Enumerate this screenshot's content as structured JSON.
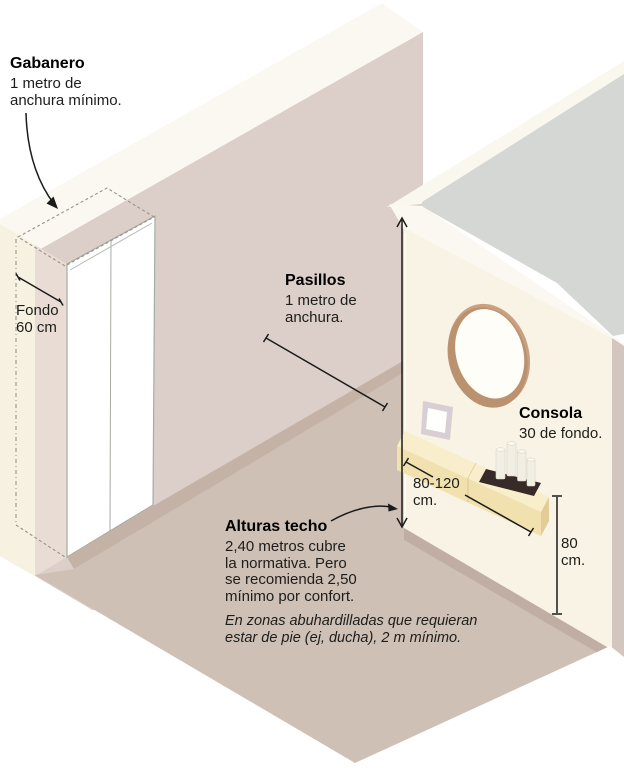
{
  "figure": {
    "type": "isometric-hallway-infographic",
    "language": "es"
  },
  "palette": {
    "background": "#ffffff",
    "left_wall": "#dccfc9",
    "wall_top_band": "#fbf8f1",
    "right_wall": "#f8f3e4",
    "hall_floor": "#cfc0b5",
    "room_floor_gray": "#d5d7d4",
    "baseboard": "#c2b0a6",
    "mirror_frame_wood": "#c9a180",
    "console_wood": "#f1e1ae",
    "tray_dark": "#382a28",
    "ink": "#1b1b1b"
  },
  "annotations": {
    "gabanero": {
      "title": "Gabanero",
      "lines": [
        "1 metro de",
        "anchura mínimo."
      ]
    },
    "fondo": {
      "lines": [
        "Fondo",
        "60 cm"
      ]
    },
    "pasillos": {
      "title": "Pasillos",
      "lines": [
        "1 metro de",
        "anchura."
      ]
    },
    "consola": {
      "title": "Consola",
      "lines": [
        "30 de fondo."
      ]
    },
    "consola_ancho": {
      "lines": [
        "80-120",
        "cm."
      ]
    },
    "consola_alto": {
      "lines": [
        "80",
        "cm."
      ]
    },
    "alturas": {
      "title": "Alturas techo",
      "lines": [
        "2,40 metros cubre",
        "la normativa. Pero",
        "se recomienda 2,50",
        "mínimo por confort."
      ],
      "note_lines": [
        "En zonas abuhardilladas que requieran",
        "estar de pie (ej, ducha), 2 m mínimo."
      ]
    }
  }
}
